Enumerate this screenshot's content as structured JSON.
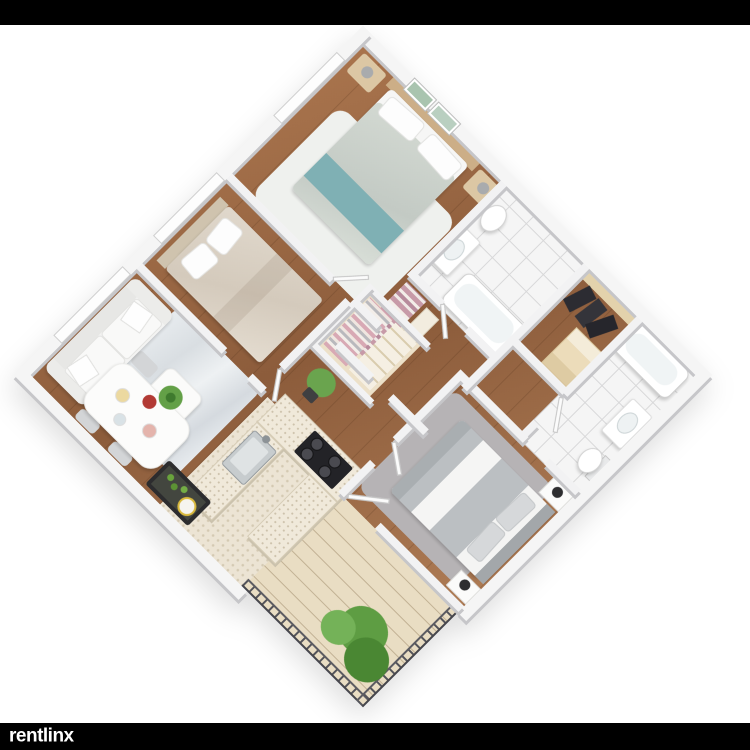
{
  "branding": {
    "logo_text": "rentlinx"
  },
  "layout": {
    "background": "#ffffff",
    "top_bar_color": "#000000",
    "bottom_bar_color": "#000000",
    "logo_text_color": "#ffffff"
  },
  "palette": {
    "wall_top": "#f2f2f3",
    "wall_face": "#c6c6c9",
    "wood_floor": "#9a6a47",
    "white_tile": "#f5f5f5",
    "kitchen_tile": "#ece4d4",
    "deck": "#e9ddc3",
    "railing": "#4e4e52",
    "sofa": "#f3f3f2",
    "bed1_duvet": "#ccd3cd",
    "teal_throw": "#7fb0b4",
    "bed2_duvet": "#dbd2c5",
    "bed3_duvet": "#bbbfc2",
    "counter": "#f0e9da",
    "stove": "#232327",
    "plant_green": "#5f9e44",
    "suits_dark": "#2c2c32",
    "clothes_pink": "#c79aa8"
  },
  "floorplan": {
    "type": "3d-isometric-apartment-render",
    "rotation_deg": 45,
    "rooms": [
      {
        "name": "bedroom-1",
        "floor": "wood",
        "items": [
          "double-bed-sage-duvet",
          "teal-throw",
          "white-pillows",
          "wood-headboard",
          "nightstand-left",
          "nightstand-right",
          "cactus-art-frame-1",
          "cactus-art-frame-2",
          "white-area-rug",
          "window"
        ]
      },
      {
        "name": "bathroom-1",
        "floor": "white-tile",
        "items": [
          "toilet",
          "vanity-sink",
          "bathtub"
        ]
      },
      {
        "name": "walk-in-closet",
        "floor": "wood",
        "items": [
          "hanging-clothes-pink",
          "white-shelf"
        ]
      },
      {
        "name": "suit-closet",
        "floor": "wood",
        "items": [
          "hanging-dark-suits",
          "light-wood-shelf-unit",
          "wood-back-panel"
        ]
      },
      {
        "name": "bathroom-2",
        "floor": "white-tile",
        "items": [
          "bathtub",
          "vanity-sink",
          "toilet"
        ]
      },
      {
        "name": "bedroom-3",
        "floor": "wood",
        "items": [
          "double-bed-gray-white-stripe",
          "upholstered-headboard",
          "nightstand-with-lamp-1",
          "nightstand-with-lamp-2",
          "gray-shag-rug"
        ]
      },
      {
        "name": "balcony",
        "floor": "deck-planks",
        "items": [
          "metal-railing-left",
          "metal-railing-right",
          "leafy-green-plant"
        ]
      },
      {
        "name": "kitchen",
        "floor": "beige-speckled-tile",
        "items": [
          "u-shaped-counter",
          "gas-cooktop-4-burners",
          "stainless-sink",
          "dark-bar-cabinet-with-bottles"
        ]
      },
      {
        "name": "dining-area",
        "floor": "wood",
        "items": [
          "white-dining-table",
          "flower-centerpiece",
          "plates-of-food",
          "gray-chairs"
        ]
      },
      {
        "name": "living-room",
        "floor": "wood",
        "items": [
          "white-sofa",
          "throw-pillows",
          "gray-white-area-rug",
          "coffee-table-with-plant",
          "windows"
        ]
      },
      {
        "name": "bedroom-2",
        "floor": "wood",
        "items": [
          "double-bed-beige-duvet",
          "white-pillows",
          "headboard",
          "window"
        ]
      },
      {
        "name": "hallway",
        "floor": "wood",
        "items": [
          "open-wardrobe-unit",
          "potted-plant",
          "interior-doors"
        ]
      }
    ]
  }
}
